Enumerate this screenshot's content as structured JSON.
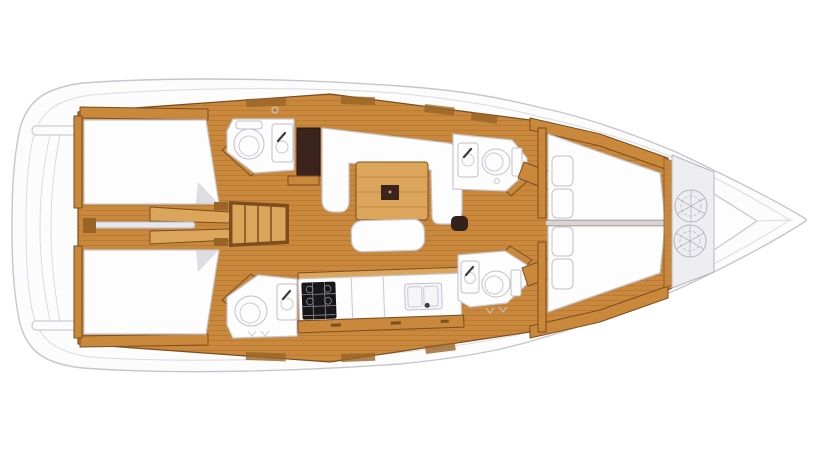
{
  "scene": {
    "kind": "sailing-yacht-interior-floor-plan",
    "view": "top-down-deck-plan",
    "bow_direction": "right",
    "visible_text": "none"
  },
  "summary": {
    "aft_double_cabins": 2,
    "forward_berths": 2,
    "heads_with_toilet": 4,
    "saloon_table_count": 1,
    "companionway_tread_count": 4,
    "galley_burner_count": 4,
    "bow_rope_coils": 2,
    "berth_pillows": 4
  },
  "regions": [
    {
      "id": "stern-transom"
    },
    {
      "id": "aft-cabin-port"
    },
    {
      "id": "aft-cabin-starboard"
    },
    {
      "id": "companionway-steps"
    },
    {
      "id": "aft-head-port"
    },
    {
      "id": "aft-head-starboard"
    },
    {
      "id": "saloon-settee"
    },
    {
      "id": "saloon-table"
    },
    {
      "id": "galley"
    },
    {
      "id": "forward-head-port"
    },
    {
      "id": "forward-head-starboard"
    },
    {
      "id": "forward-cabin-twin-berths"
    },
    {
      "id": "bow-sail-locker"
    },
    {
      "id": "bow-tip"
    }
  ],
  "colors": {
    "background": "#ffffff",
    "hull_fill": "#fcfcfd",
    "hull_stroke": "#c5c5cd",
    "deck_line": "#dadae0",
    "wood_light": "#dca55c",
    "wood_mid": "#c9883c",
    "wood_dark": "#9a6426",
    "wood_edge": "#7c4e1d",
    "plank_line": "#aa6f2c",
    "furniture_white": "#fdfdfe",
    "furniture_stroke": "#c6c6ce",
    "shadow_grey": "#c3c3cb",
    "dark_brown": "#3a241d",
    "stove_black": "#17171a",
    "metal_dark": "#3a3a42",
    "locker_grey": "#eeeef2",
    "rope_stroke": "#b4b4be"
  }
}
